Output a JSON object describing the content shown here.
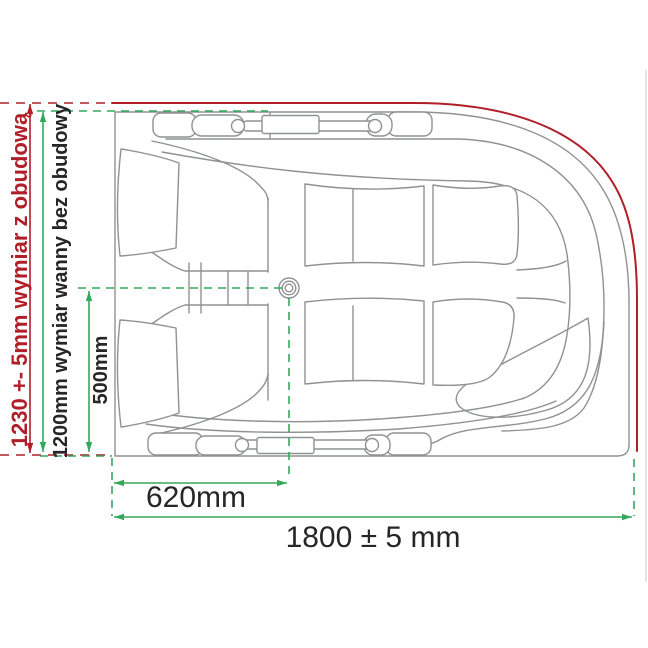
{
  "labels": {
    "outer_height": "1230 +- 5mm wymiar z obudową",
    "tub_height": "1200mm wymiar wanny bez obudowy",
    "drain_offset_y": "500mm",
    "drain_offset_x": "620mm",
    "total_length": "1800 ± 5 mm"
  },
  "colors": {
    "outer_dimension_red": "#b01e28",
    "inner_dimension_green": "#33a95e",
    "drawing_line_gray": "#8f9193",
    "label_text": "#262626"
  }
}
